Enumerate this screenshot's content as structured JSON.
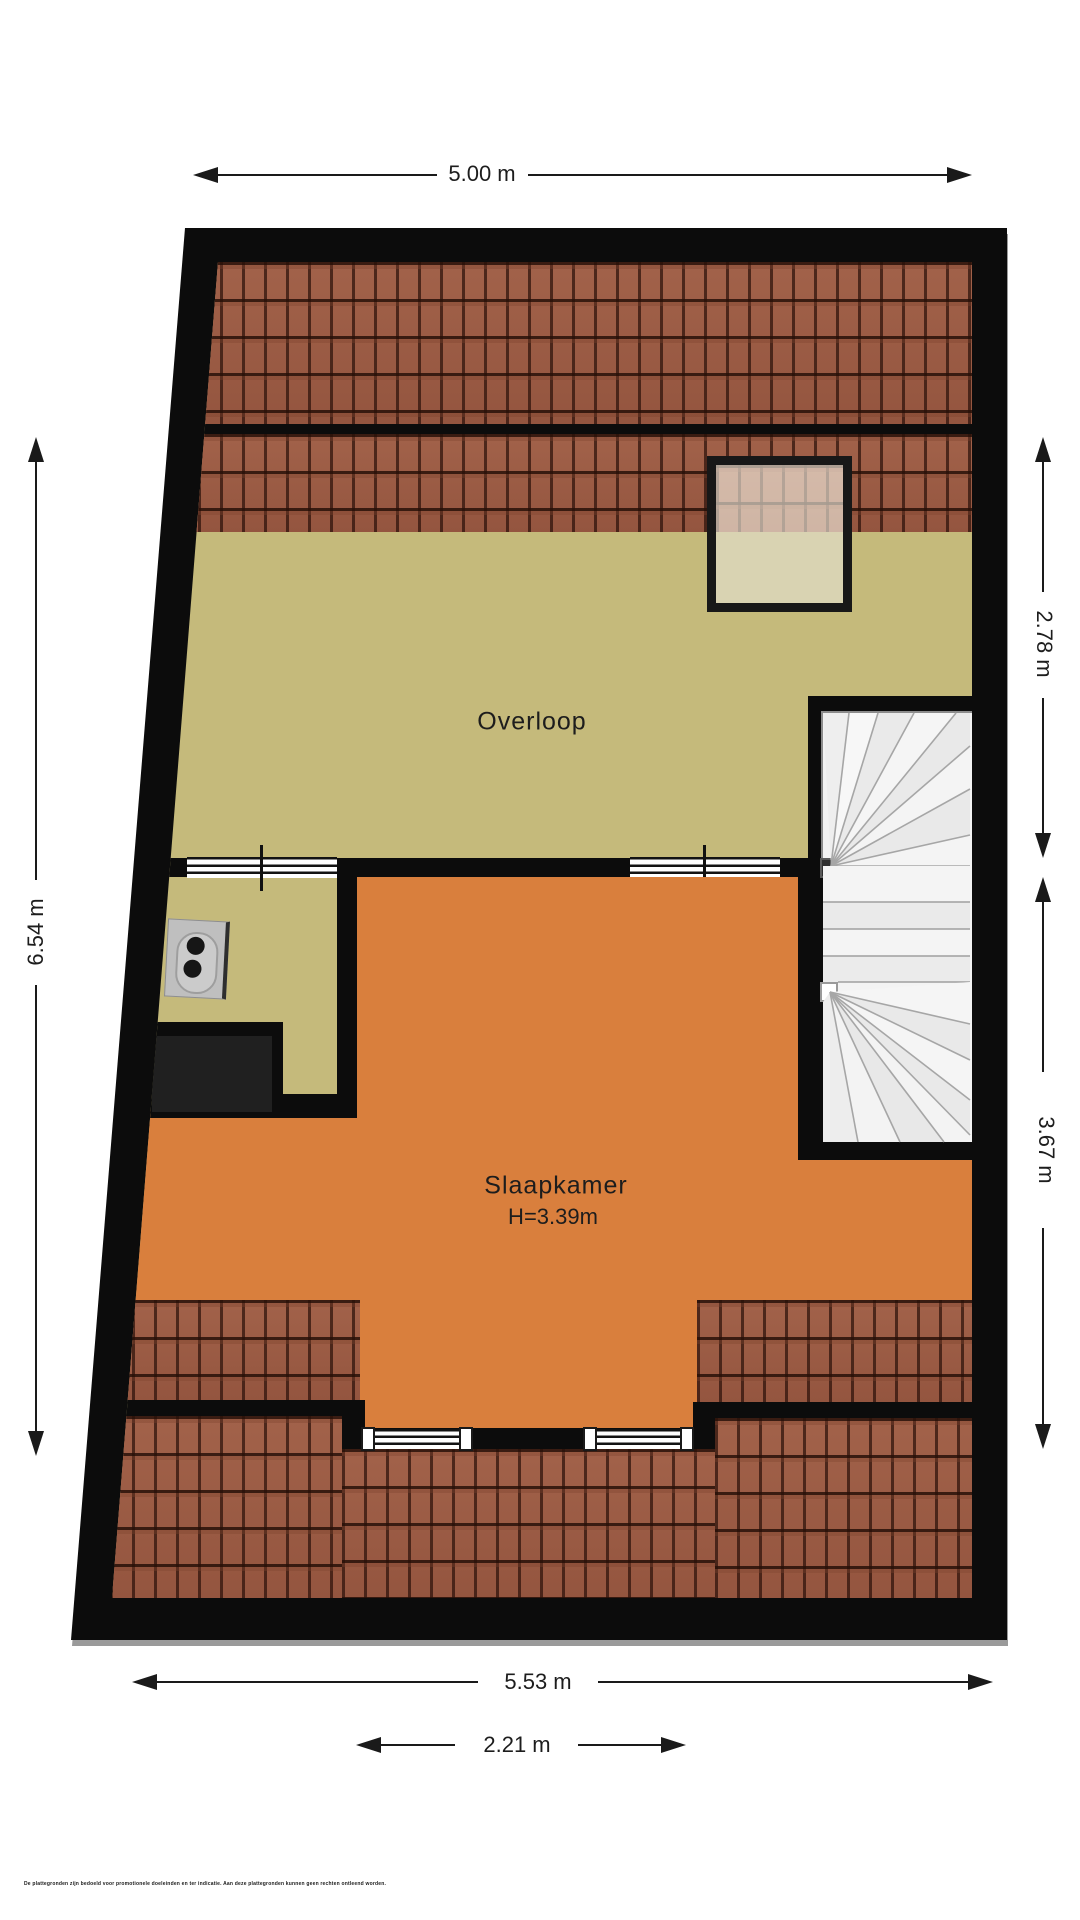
{
  "plan": {
    "rooms": {
      "overloop": {
        "name": "Overloop"
      },
      "slaapkamer": {
        "name": "Slaapkamer",
        "height_label": "H=3.39m"
      }
    },
    "dimensions": {
      "top": "5.00 m",
      "left": "6.54 m",
      "right_upper": "2.78 m",
      "right_lower": "3.67 m",
      "bottom_outer": "5.53 m",
      "bottom_inner": "2.21 m"
    },
    "disclaimer": "De plattegronden zijn bedoeld voor promotionele doeleinden en ter indicatie. Aan deze plattegronden kunnen geen rechten ontleend worden.",
    "colors": {
      "room_orange": "#d97f3d",
      "floor_olive": "#c5ba7b",
      "roof_tile": "#9d5e46",
      "wall_black": "#0c0c0c",
      "stair_white": "#f3f3f3"
    }
  }
}
